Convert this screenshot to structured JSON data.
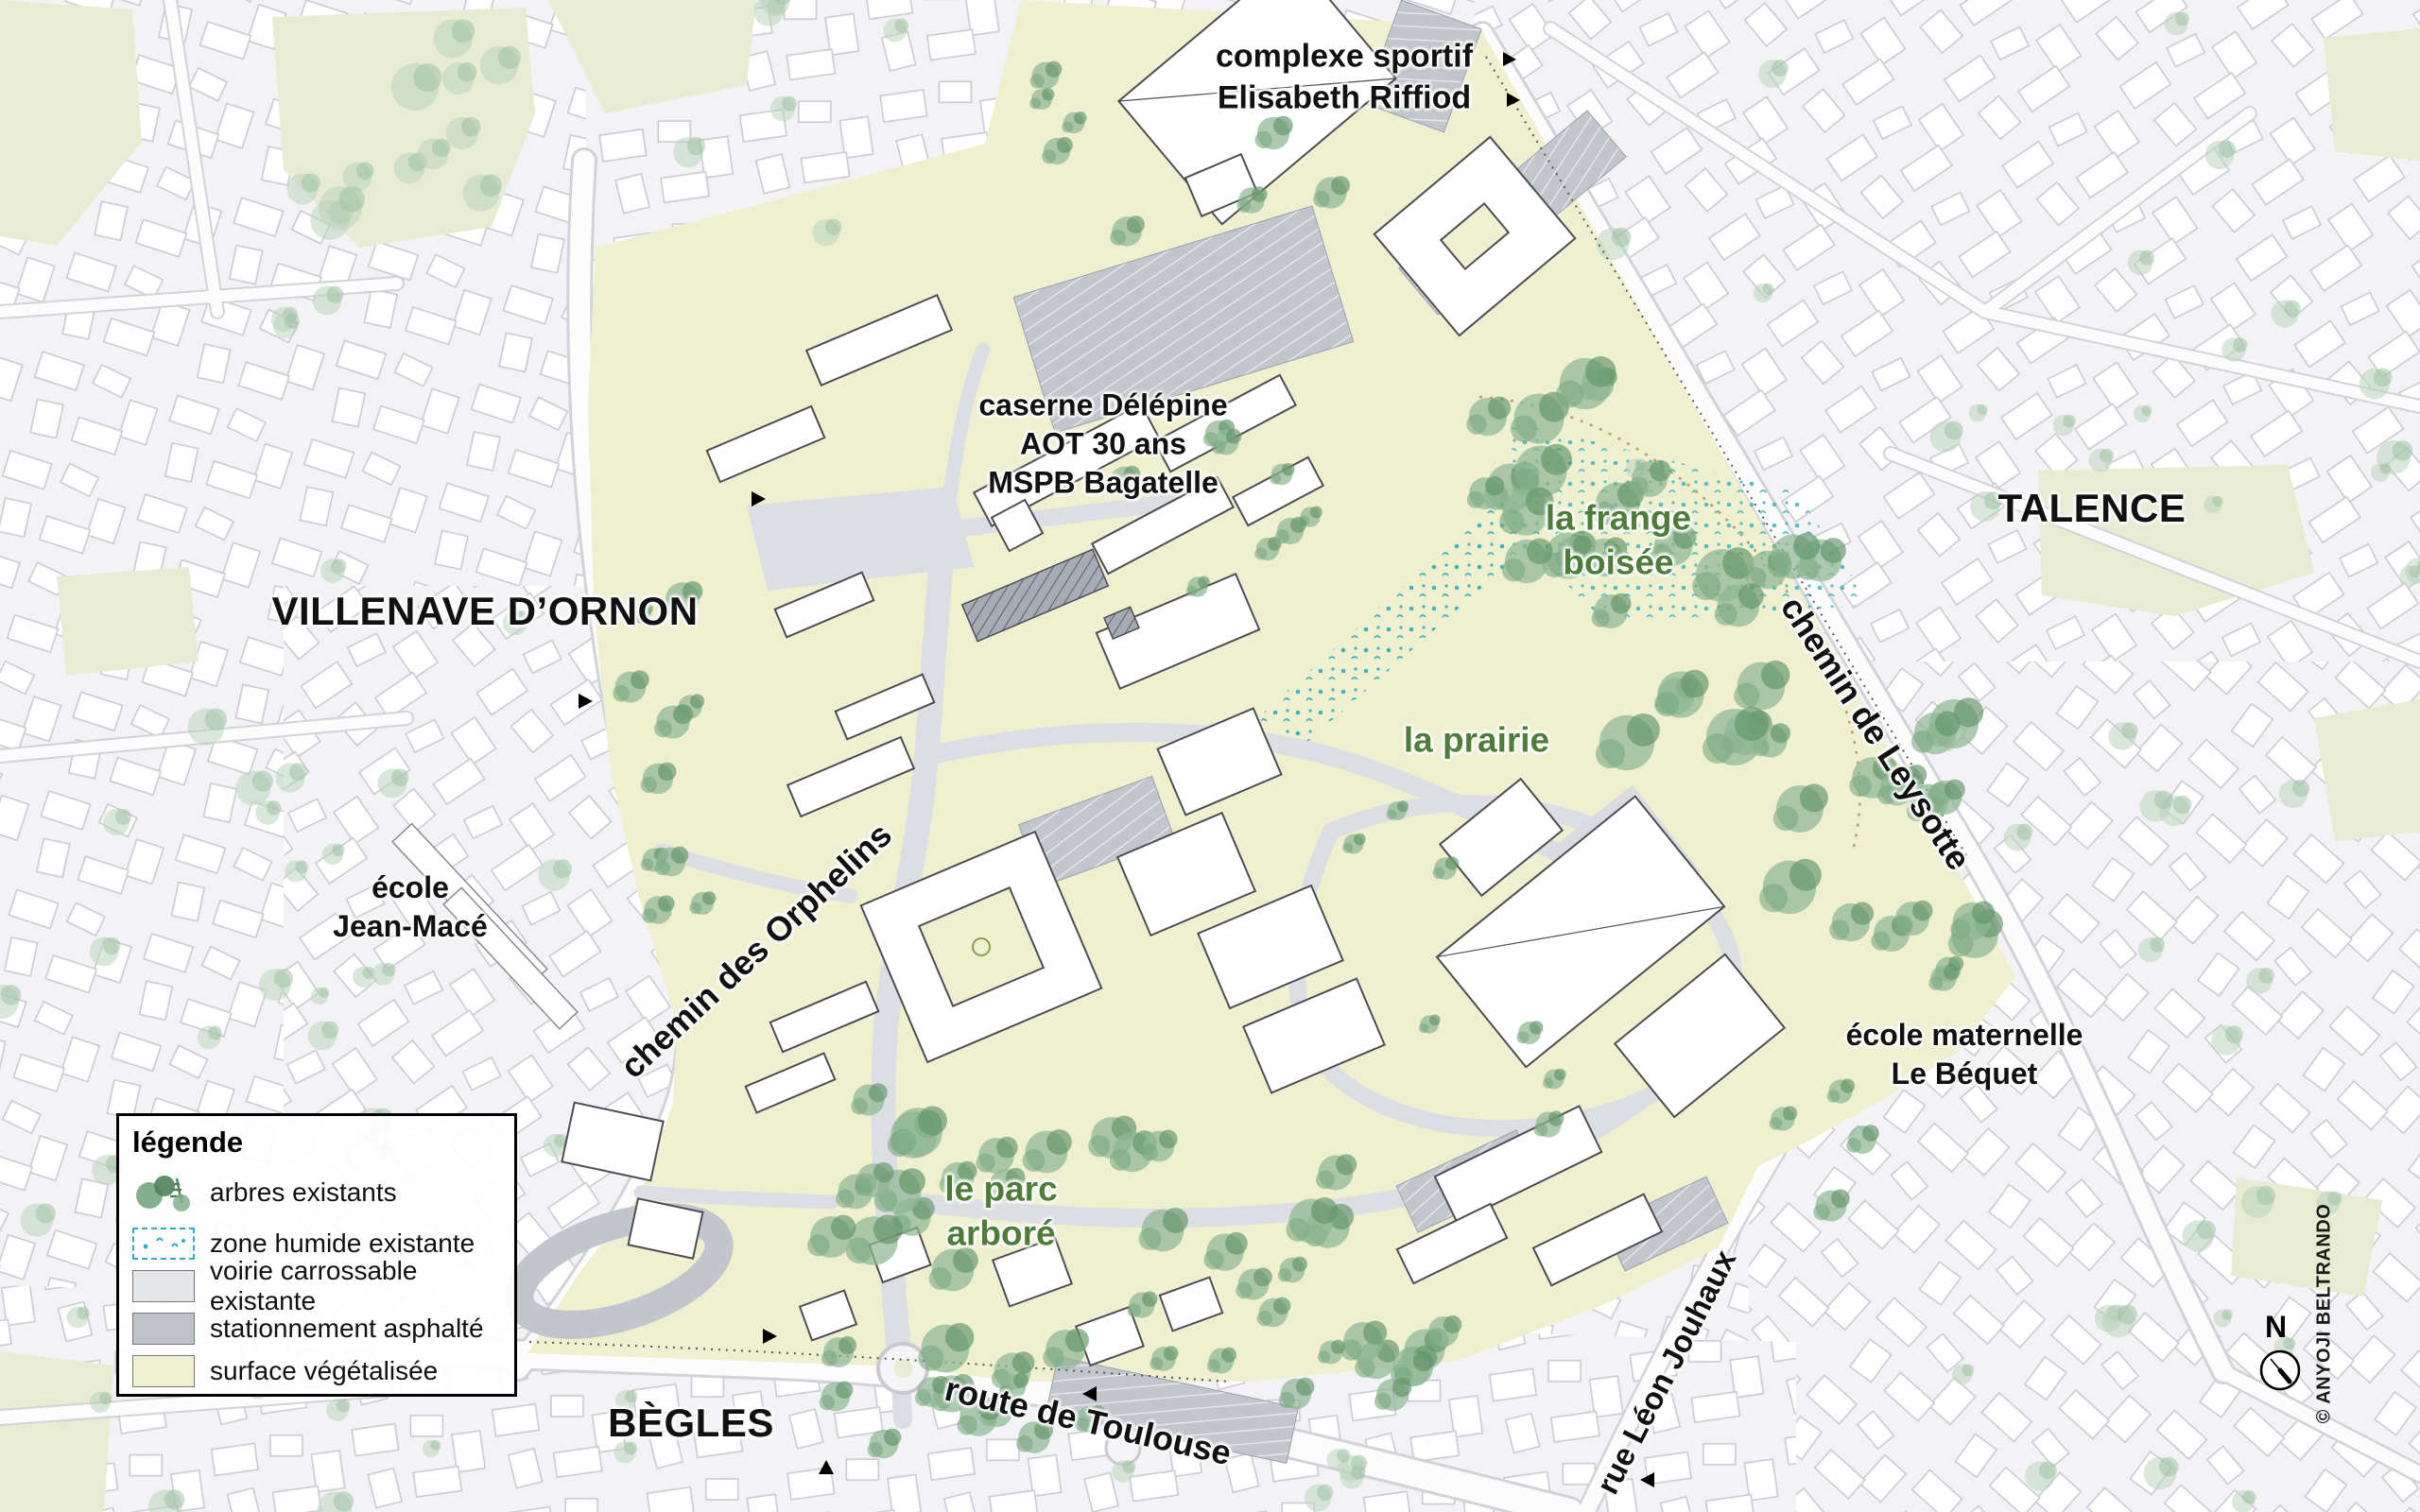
{
  "legend": {
    "title": "légende",
    "items": [
      {
        "id": "trees",
        "label": "arbres existants"
      },
      {
        "id": "wetland",
        "label": "zone humide existante"
      },
      {
        "id": "road",
        "label": "voirie carrossable existante"
      },
      {
        "id": "parking",
        "label": "stationnement asphalté"
      },
      {
        "id": "vegetated",
        "label": "surface végétalisée"
      }
    ]
  },
  "places": {
    "complexe_sportif": [
      "complexe sportif",
      "Elisabeth Riffiod"
    ],
    "caserne": [
      "caserne Délépine",
      "AOT 30 ans",
      "MSPB Bagatelle"
    ],
    "villenave": "VILLENAVE D’ORNON",
    "talence": "TALENCE",
    "begles": "BÈGLES",
    "ecole_jean_mace": [
      "école",
      "Jean-Macé"
    ],
    "ecole_maternelle": [
      "école maternelle",
      "Le Béquet"
    ],
    "frange_boisee": [
      "la frange",
      "boisée"
    ],
    "prairie": "la prairie",
    "parc_arbore": [
      "le parc",
      "arboré"
    ]
  },
  "roads": {
    "chemin_orphelins": "chemin des Orphelins",
    "chemin_leysotte": "chemin de Leysotte",
    "route_toulouse": "route de Toulouse",
    "rue_jouhaux": "rue Léon Jouhaux"
  },
  "compass": {
    "north": "N"
  },
  "credit": "© ANYOJI BELTRANDO",
  "colors": {
    "vegetated_surface": "#eef0d0",
    "drivable_road": "#dcdee3",
    "asphalt_parking": "#c2c5cc",
    "existing_trees": "#6f9f77",
    "wetland_marks": "#3fb3bc",
    "green_label": "#4e7c3a",
    "city_fabric": "#f3f3f6"
  }
}
